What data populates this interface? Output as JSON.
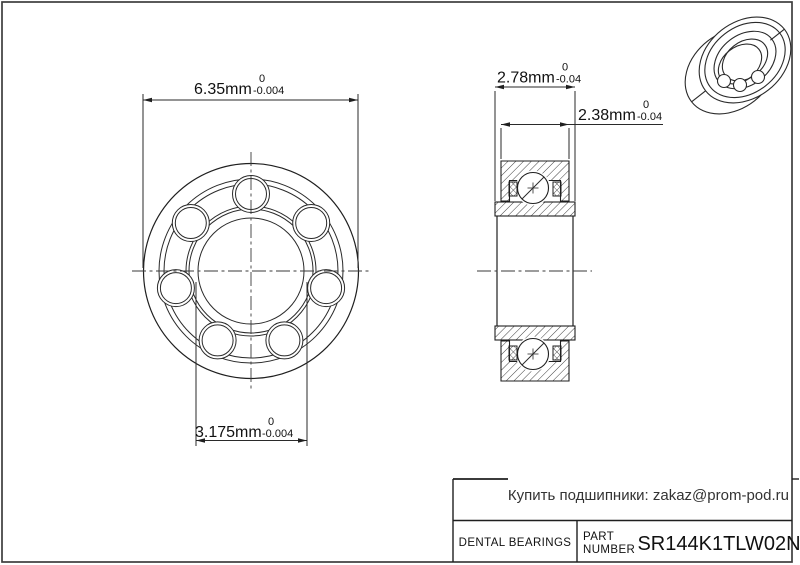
{
  "drawing": {
    "dims": {
      "outer_diameter": {
        "value": "6.35mm",
        "tol_upper": "0",
        "tol_lower": "-0.004"
      },
      "bore_diameter": {
        "value": "3.175mm",
        "tol_upper": "0",
        "tol_lower": "-0.004"
      },
      "inner_ring_width": {
        "value": "2.78mm",
        "tol_upper": "0",
        "tol_lower": "-0.04"
      },
      "outer_ring_width": {
        "value": "2.38mm",
        "tol_upper": "0",
        "tol_lower": "-0.04"
      }
    }
  },
  "title_block": {
    "vendor_note": "Купить подшипники: zakaz@prom-pod.ru",
    "category": "DENTAL BEARINGS",
    "part_label_line1": "PART",
    "part_label_line2": "NUMBER",
    "part_number": "SR144K1TLW02N"
  },
  "colors": {
    "line": "#1f1f1f",
    "frame": "#3d3d3d",
    "background": "#ffffff"
  }
}
